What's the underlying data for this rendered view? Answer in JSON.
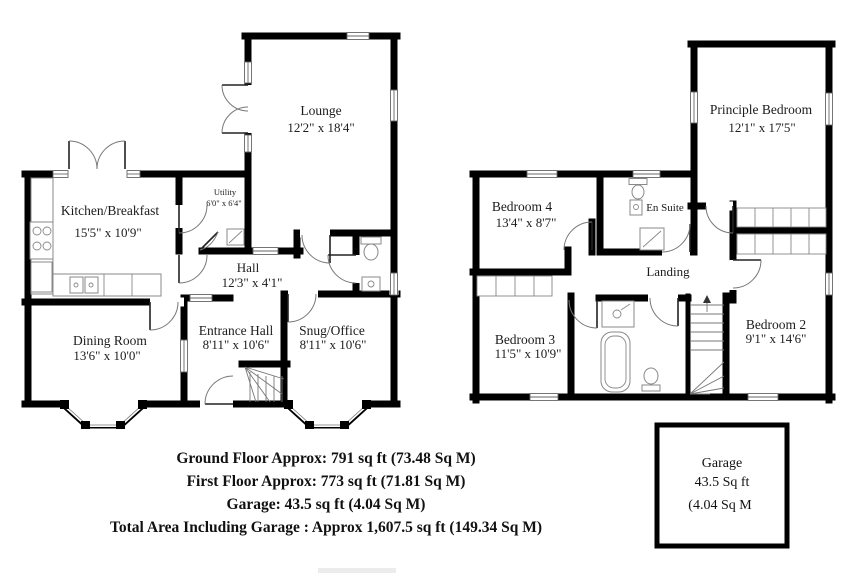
{
  "ground_floor": {
    "rooms": {
      "lounge": {
        "name": "Lounge",
        "dims": "12'2\" x 18'4\""
      },
      "kitchen": {
        "name": "Kitchen/Breakfast",
        "dims": "15'5\" x 10'9\""
      },
      "utility": {
        "name": "Utility",
        "dims": "6'0\" x 6'4\""
      },
      "hall": {
        "name": "Hall",
        "dims": "12'3\" x 4'1\""
      },
      "dining": {
        "name": "Dining Room",
        "dims": "13'6\" x 10'0\""
      },
      "entrance": {
        "name": "Entrance Hall",
        "dims": "8'11\" x 10'6\""
      },
      "snug": {
        "name": "Snug/Office",
        "dims": "8'11\" x 10'6\""
      }
    }
  },
  "first_floor": {
    "rooms": {
      "principle": {
        "name": "Principle Bedroom",
        "dims": "12'1\" x 17'5\""
      },
      "bedroom4": {
        "name": "Bedroom 4",
        "dims": "13'4\" x 8'7\""
      },
      "ensuite": {
        "name": "En Suite"
      },
      "landing": {
        "name": "Landing"
      },
      "bedroom3": {
        "name": "Bedroom 3",
        "dims": "11'5\" x 10'9\""
      },
      "bedroom2": {
        "name": "Bedroom 2",
        "dims": "9'1\" x 14'6\""
      }
    }
  },
  "garage_box": {
    "name": "Garage",
    "area_ft": "43.5 Sq ft",
    "area_m": "(4.04 Sq M"
  },
  "summary": {
    "lines": [
      "Ground Floor Approx: 791 sq ft (73.48 Sq M)",
      "First Floor Approx: 773 sq ft (71.81 Sq M)",
      "Garage: 43.5 sq ft (4.04 Sq M)",
      "Total Area Including Garage : Approx 1,607.5 sq ft (149.34 Sq M)"
    ]
  },
  "colors": {
    "wall": "#000000",
    "background": "#ffffff"
  }
}
